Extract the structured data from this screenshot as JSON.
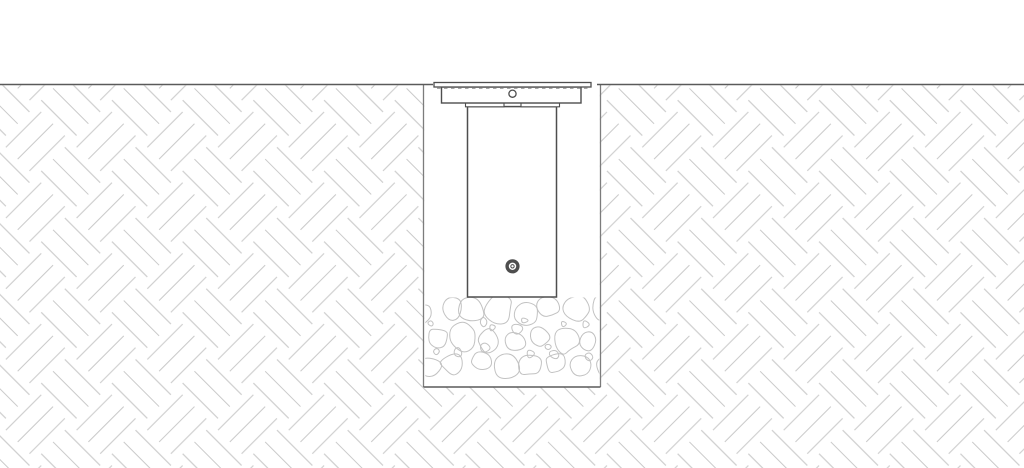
{
  "canvas": {
    "width": 1024,
    "height": 468
  },
  "colors": {
    "background": "#ffffff",
    "ground_line": "#5a5a5a",
    "trench_wall": "#7c7c7c",
    "trench_bottom": "#5a5a5a",
    "hatch_line": "#cacaca",
    "stone_line": "#c2c2c2",
    "fixture_line": "#4e4e4e",
    "hidden_line": "#8c8c8c"
  },
  "geometry": {
    "ground_y": 84.5,
    "soil_hatch": {
      "x": 0,
      "y": 85.3,
      "w": 1024,
      "h": 382.7,
      "tile": 50,
      "stroke_width": 1.05
    },
    "trench": {
      "left": 423.5,
      "right": 600.5,
      "top": 84.5,
      "bottom": 387,
      "wall_width": 1.3,
      "bottom_width": 1.6
    },
    "ground_segments": [
      {
        "x1": 0,
        "x2": 433,
        "width": 1.6
      },
      {
        "x1": 597,
        "x2": 1024,
        "width": 1.6
      }
    ],
    "gravel": {
      "clip": {
        "x": 425.3,
        "y": 297.5,
        "w": 174,
        "h": 88.5
      },
      "row_ys": [
        311,
        338,
        365
      ],
      "row_offsets": [
        0,
        13,
        5
      ],
      "col_step": 25,
      "r_min": 10,
      "r_max": 15.5,
      "filler_count": 14,
      "filler_rows": [
        325,
        352
      ],
      "filler_r_min": 3.5,
      "filler_r_max": 6.5,
      "seed": 7,
      "stroke_width": 1
    },
    "fixture": {
      "flange": {
        "x": 434,
        "y": 82.5,
        "w": 157,
        "h": 4.5,
        "stroke_width": 1.3
      },
      "hidden_dash": {
        "x1": 437,
        "x2": 588,
        "y": 88.3,
        "dash": "3.5 3.5",
        "stroke_width": 1
      },
      "housing": {
        "x": 441.5,
        "y": 87,
        "w": 139.5,
        "h": 16,
        "stroke_width": 1.4
      },
      "tab_left": {
        "x": 465.5,
        "y": 103,
        "w": 38.5,
        "h": 3.8,
        "stroke_width": 1.1
      },
      "tab_right": {
        "x": 521,
        "y": 103,
        "w": 38.5,
        "h": 3.8,
        "stroke_width": 1.1
      },
      "body": {
        "x": 467.5,
        "y": 106.6,
        "w": 89,
        "h": 190.4,
        "stroke_width": 1.5
      },
      "top_bolt": {
        "cx": 512.5,
        "cy": 93.7,
        "r": 3.6,
        "stroke_width": 1.3
      },
      "plug": {
        "cx": 512.5,
        "cy": 266.3,
        "r": 5.4,
        "ring_width": 3.4,
        "inner_r": 1.7,
        "inner_width": 1
      }
    }
  }
}
